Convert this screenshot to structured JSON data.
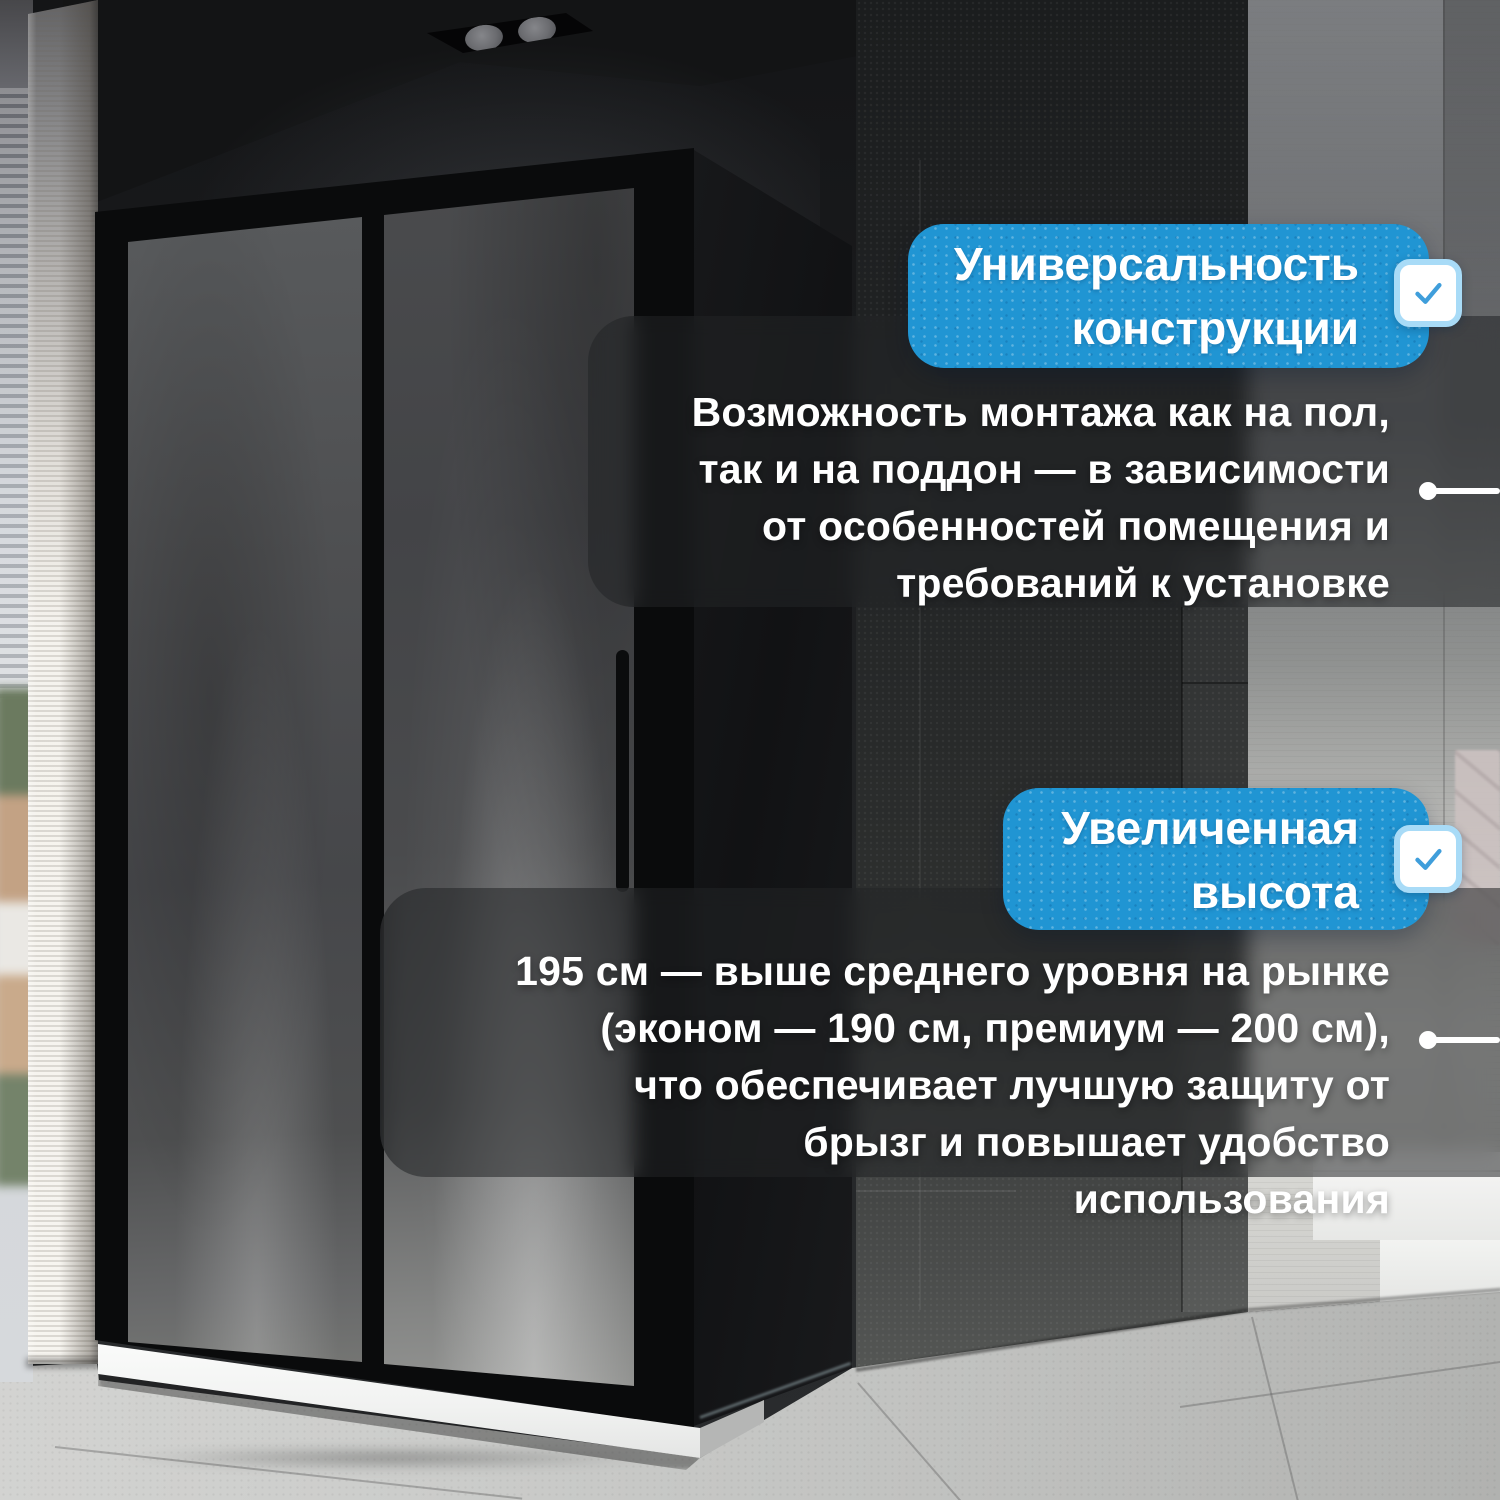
{
  "colors": {
    "accent-blue": "#2095d3",
    "check-blue": "#3f9edb",
    "checkbox-border": "#a8dbf7",
    "connector-white": "#ffffff",
    "text-white": "#ffffff",
    "overlay-dark": "rgba(35,36,38,0.55)"
  },
  "cards": [
    {
      "badge_lines": [
        "Универсальность",
        "конструкции"
      ],
      "checkbox_icon": "checkmark-icon",
      "description_lines": [
        "Возможность монтажа как на пол,",
        "так и на поддон — в зависимости",
        "от особенностей помещения и",
        "требований к установке"
      ]
    },
    {
      "badge_lines": [
        "Увеличенная",
        "высота"
      ],
      "checkbox_icon": "checkmark-icon",
      "description_lines": [
        "195 см — выше среднего уровня на рынке",
        "(эконом — 190 см, премиум — 200 см),",
        "что обеспечивает лучшую защиту от",
        "брызг и повышает удобство",
        "использования"
      ]
    }
  ],
  "scene": {
    "subject": "Душевой уголок с чёрным профилем и матовым стеклом в ванной комнате"
  }
}
